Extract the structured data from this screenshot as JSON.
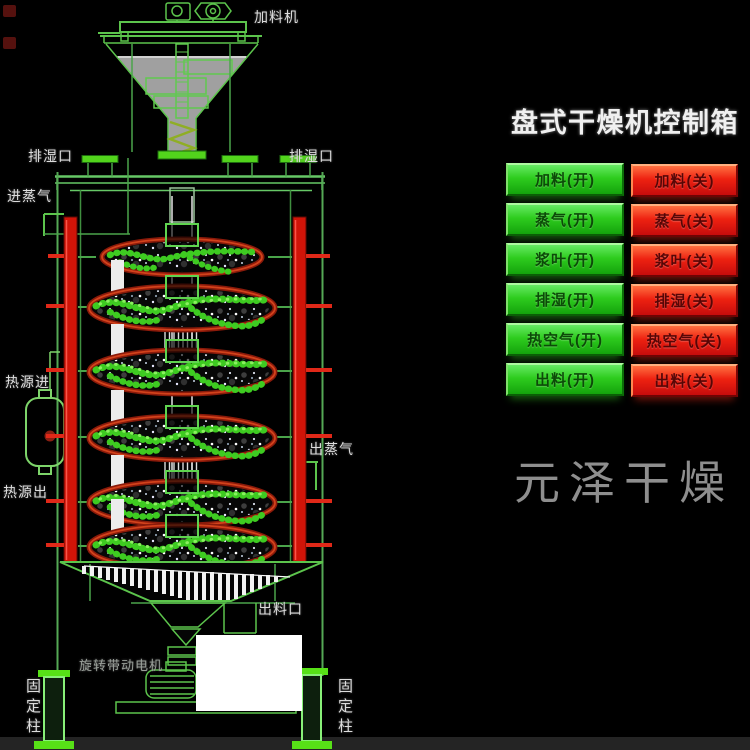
{
  "machine": {
    "labels": {
      "feeder": "加料机",
      "vent_left": "排湿口",
      "vent_right": "排湿口",
      "steam_in": "进蒸气",
      "heat_in": "热源进",
      "heat_out": "热源出",
      "steam_out": "出蒸气",
      "discharge": "出料口",
      "motor": "旋转带动电机",
      "column_left": "固定柱",
      "column_right": "固定柱"
    }
  },
  "panel": {
    "title": "盘式干燥机控制箱",
    "rows": [
      {
        "on": "加料(开)",
        "off": "加料(关)"
      },
      {
        "on": "蒸气(开)",
        "off": "蒸气(关)"
      },
      {
        "on": "浆叶(开)",
        "off": "浆叶(关)"
      },
      {
        "on": "排湿(开)",
        "off": "排湿(关)"
      },
      {
        "on": "热空气(开)",
        "off": "热空气(关)"
      },
      {
        "on": "出料(开)",
        "off": "出料(关)"
      }
    ],
    "colors": {
      "button_on": "#2ecc1e",
      "button_off": "#e01818"
    }
  },
  "watermark": "元泽干燥",
  "colors": {
    "line_green": "#55c42a",
    "column_red": "#d01408",
    "disc_rim": "#a8260e"
  }
}
